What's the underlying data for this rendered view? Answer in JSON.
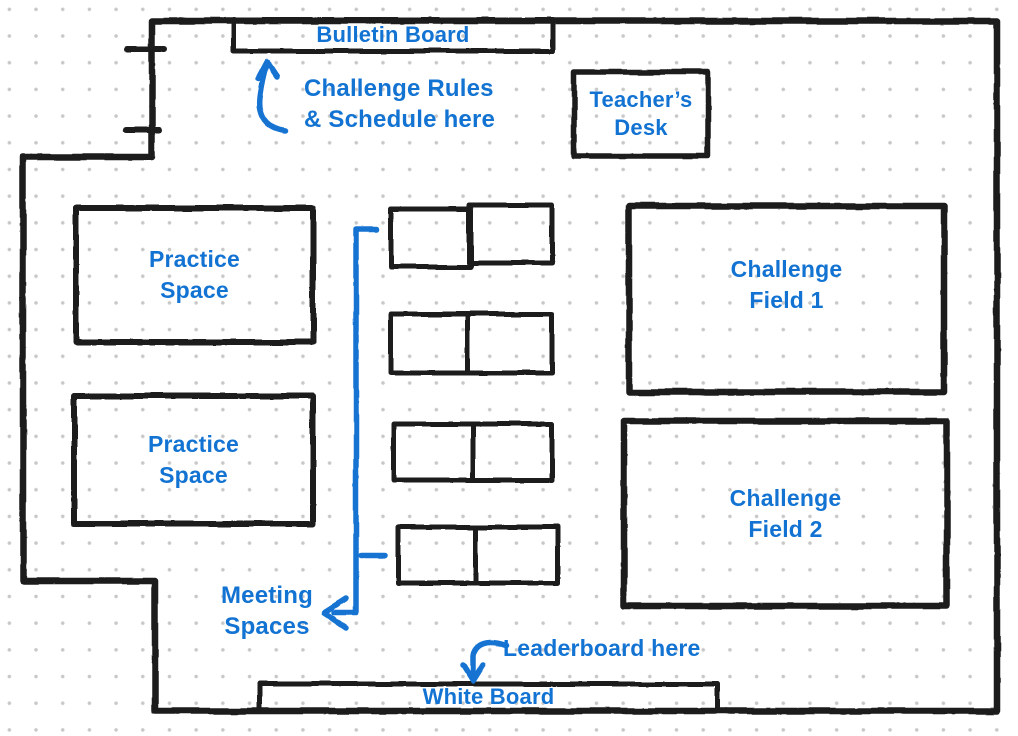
{
  "diagram": {
    "type": "classroom-floor-plan-sketch",
    "colors": {
      "wall_ink": "#1d1d1d",
      "annotation_blue": "#1273d2",
      "grid_dot": "#c8c8c8",
      "background": "#ffffff"
    },
    "areas": {
      "bulletin_board": {
        "label": "Bulletin Board"
      },
      "teachers_desk": {
        "line1": "Teacher’s",
        "line2": "Desk"
      },
      "practice_space_1": {
        "line1": "Practice",
        "line2": "Space"
      },
      "practice_space_2": {
        "line1": "Practice",
        "line2": "Space"
      },
      "challenge_field_1": {
        "line1": "Challenge",
        "line2": "Field 1"
      },
      "challenge_field_2": {
        "line1": "Challenge",
        "line2": "Field 2"
      },
      "white_board": {
        "label": "White Board"
      }
    },
    "annotations": {
      "rules_note": {
        "line1": "Challenge Rules",
        "line2": "& Schedule here",
        "arrow_icon": "up-arrow-to-bulletin-board"
      },
      "meeting_note": {
        "line1": "Meeting",
        "line2": "Spaces",
        "arrow_icon": "bracket-arrow-spanning-tables"
      },
      "leaderboard_note": {
        "label": "Leaderboard here",
        "arrow_icon": "down-arrow-to-white-board"
      }
    },
    "meeting_tables_count": 4,
    "door_ticks_count": 2
  }
}
